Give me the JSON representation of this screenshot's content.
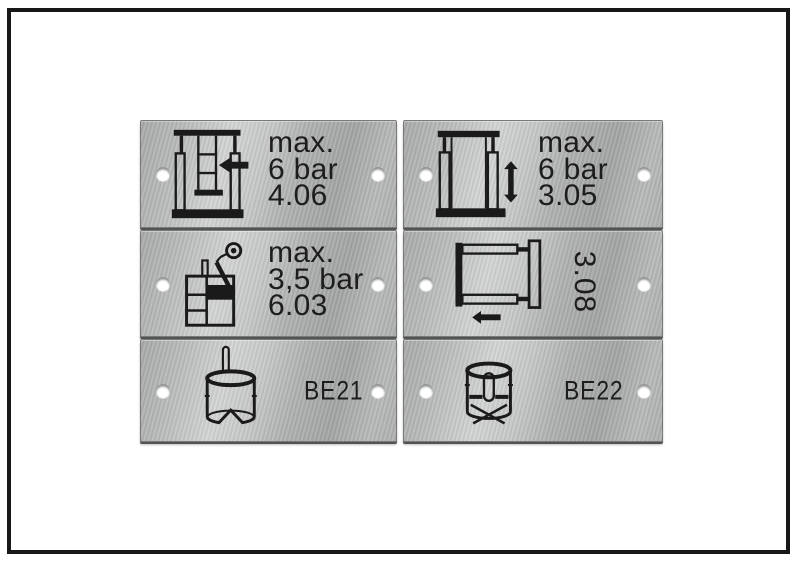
{
  "colors": {
    "background": "#ffffff",
    "frame": "#181818",
    "plate_base": "#b5b7b6",
    "plate_highlight": "#d2d4d3",
    "plate_shadow": "#a2a4a3",
    "engraving": "#1d1d1d",
    "hole": "#ffffff"
  },
  "plates": [
    {
      "name": "pressing-station-plate",
      "icon": "press-ram-arrow-icon",
      "lines": [
        "max.",
        "6 bar",
        "4.06"
      ]
    },
    {
      "name": "lifting-frame-plate",
      "icon": "vertical-stroke-frame-icon",
      "lines": [
        "max.",
        "6 bar",
        "3.05"
      ]
    },
    {
      "name": "spray-gun-tank-plate",
      "icon": "spray-gun-tank-icon",
      "lines": [
        "max.",
        "3,5 bar",
        "6.03"
      ]
    },
    {
      "name": "slide-frame-plate",
      "icon": "horizontal-slide-frame-icon",
      "rotated_label": "3.08"
    },
    {
      "name": "tool-be21-plate",
      "icon": "cylinder-pin-top-icon",
      "label": "BE21"
    },
    {
      "name": "tool-be22-plate",
      "icon": "cylinder-pin-inside-icon",
      "label": "BE22"
    }
  ]
}
